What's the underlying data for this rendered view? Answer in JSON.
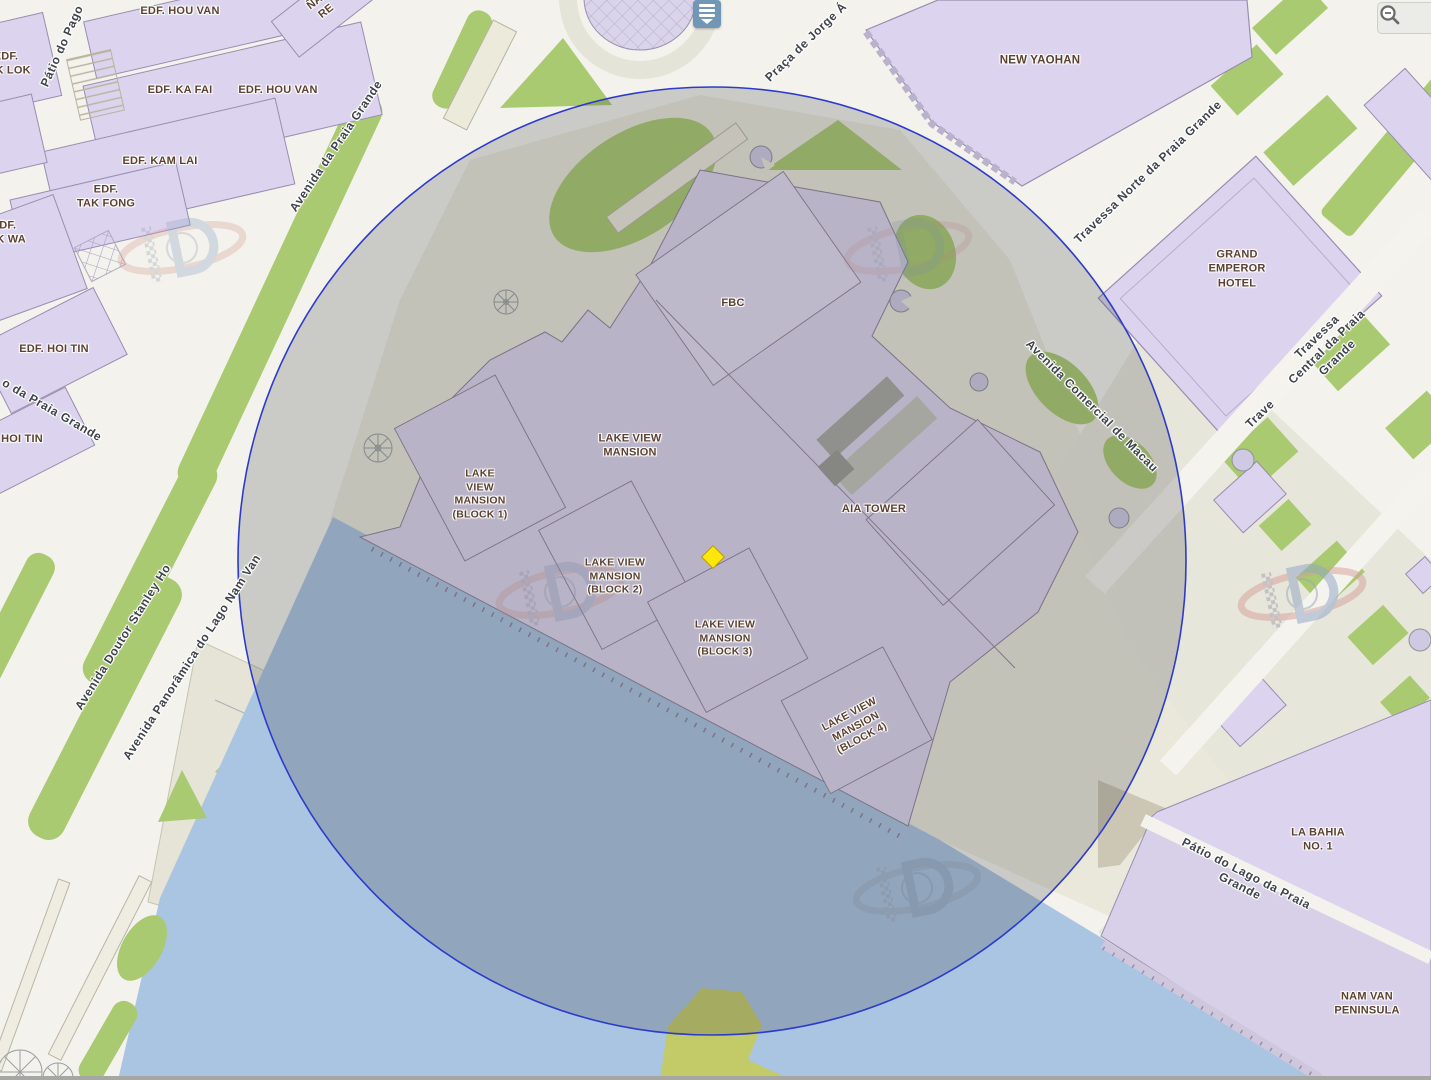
{
  "title": "Macau GIS map viewer",
  "labels": {
    "buildings": [
      {
        "text": "EDF. HOU VAN"
      },
      {
        "text": "EDF.\nTAK LOK"
      },
      {
        "text": "EDF. KA FAI"
      },
      {
        "text": "EDF. HOU VAN"
      },
      {
        "text": "EDF. KAM LAI"
      },
      {
        "text": "EDF.\nTAK FONG"
      },
      {
        "text": "EDF.\nTAK WA"
      },
      {
        "text": "EDF. HOI TIN"
      },
      {
        "text": "HOI TIN"
      },
      {
        "text": "ÑAL\nRE"
      },
      {
        "text": "NEW YAOHAN"
      },
      {
        "text": "GRAND\nEMPEROR\nHOTEL"
      },
      {
        "text": "FBC"
      },
      {
        "text": "LAKE VIEW\nMANSION"
      },
      {
        "text": "LAKE\nVIEW\nMANSION\n(BLOCK 1)"
      },
      {
        "text": "LAKE VIEW\nMANSION\n(BLOCK 2)"
      },
      {
        "text": "LAKE VIEW\nMANSION\n(BLOCK 3)"
      },
      {
        "text": "LAKE VIEW\nMANSION\n(BLOCK 4)"
      },
      {
        "text": "AIA TOWER"
      },
      {
        "text": "LA BAHIA\nNO. 1"
      },
      {
        "text": "NAM VAN\nPENINSULA"
      }
    ],
    "streets": [
      {
        "text": "Avenida da Praia Grande"
      },
      {
        "text": "Pátio do Pago"
      },
      {
        "text": "o da Praia Grande"
      },
      {
        "text": "Avenida Doutor Stanley Ho"
      },
      {
        "text": "Avenida Panorâmica do Lago Nam Van"
      },
      {
        "text": "Praça de Jorge Á"
      },
      {
        "text": "Travessa Norte da Praia Grande"
      },
      {
        "text": "Travessa Central da Praia Grande"
      },
      {
        "text": "Avenida Comercial de Macau"
      },
      {
        "text": "Pátio do Lago da Praia Grande"
      },
      {
        "text": "Trave"
      }
    ]
  },
  "ui": {
    "widget_icon": "layers-widget",
    "zoom_in_icon": "zoom-in-magnifier",
    "zoom_out_icon": "zoom-out-magnifier"
  },
  "marker": {
    "shape": "diamond",
    "x": 713,
    "y": 557,
    "color": "#ffe60a"
  },
  "buffer_circle": {
    "cx": 712,
    "cy": 561,
    "r": 474,
    "stroke": "#2d3bcb",
    "fill": "rgba(60,60,64,0.22)"
  },
  "colors": {
    "street_base": "#f3f2ec",
    "sidewalk": "#e9e8db",
    "building": "#dcd4ee",
    "building_outline": "#998db0",
    "green": "#a9ca70",
    "water": "#aac5e1",
    "label_building": "#5d4130",
    "label_street": "#3f434b"
  }
}
